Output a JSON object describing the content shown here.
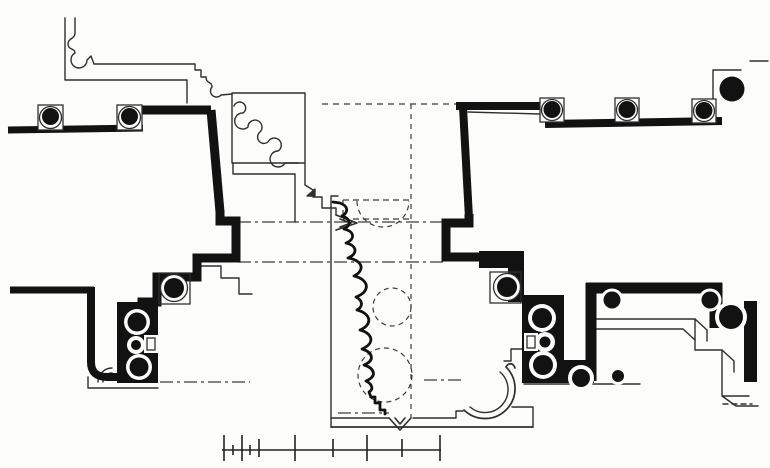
{
  "canvas": {
    "width": 770,
    "height": 468,
    "paper": "#fcfcfa",
    "ink": "#121212"
  },
  "figure": {
    "kind": "architectural-plan-drawing",
    "visible_text": ""
  },
  "drawing": {
    "layers": [
      {
        "name": "construction-lines",
        "style": {
          "stroke": "#3d3d3d",
          "width": 1.2,
          "fill": "none"
        },
        "items": [
          {
            "name": "dashed-axis-horizontal-top",
            "d": "M322,104 H456",
            "dash": "6 5"
          },
          {
            "name": "dashed-axis-vertical-center",
            "d": "M411,104 V418",
            "dash": "5 5"
          },
          {
            "name": "dashdot-line-upper",
            "d": "M238,222 H443",
            "dash": "13 4 3 4"
          },
          {
            "name": "dashdot-line-lower",
            "d": "M238,262 H443",
            "dash": "13 4 3 4"
          },
          {
            "name": "dashdot-line-left-bottom",
            "d": "M160,382 H250",
            "dash": "13 4 3 4"
          },
          {
            "name": "dashdot-line-right-bottom",
            "d": "M424,380 H464",
            "dash": "13 4 3 4"
          },
          {
            "name": "dashdot-line-niche-bottom",
            "d": "M338,413 H389",
            "dash": "13 4 3 4"
          },
          {
            "name": "dashed-pier-outline-box",
            "d": "M343,200 H411 M343,219 H411 M343,200 V219",
            "dash": "6 4"
          },
          {
            "name": "dashed-semicircle-top",
            "d": "M357,201 A26,26 0 0 0 409,201",
            "dash": "5 4"
          },
          {
            "name": "dashed-circle-middle",
            "cx": 392,
            "cy": 307,
            "r": 19,
            "dash": "5 4"
          },
          {
            "name": "dashed-circle-lower",
            "cx": 385,
            "cy": 375,
            "r": 27,
            "dash": "5 4"
          }
        ]
      },
      {
        "name": "thin-outlines",
        "style": {
          "stroke": "#2f2f2f",
          "width": 1.4,
          "fill": "none",
          "join": "round",
          "cap": "round"
        },
        "items": [
          {
            "name": "molding-inner-line",
            "d": "M65,18 V80 H187 V103"
          },
          {
            "name": "molding-outer-profile",
            "d": "M75,18 V33 C75,39 68,38 68,44 C68,50 75,48 75,53 A8,8 0 1 0 87,60 L91,56 L94,64 L195,64 V70 H201 V77 H206 C206,84 212,81 212,87 A6,6 0 1 0 221,95 L232,94"
          },
          {
            "name": "pier-panel-square",
            "d": "M232,93 H305 V163 H232 Z"
          },
          {
            "name": "pier-panel-molding-squiggle",
            "d": "M234,106 a6,6 0 1 1 9,7 a8,8 0 1 0 5,14 a7,7 0 1 1 12,5 a6,6 0 1 0 8,10 a7,7 0 1 1 10,9 a8,8 0 1 0 7,12 l13,0"
          },
          {
            "name": "project-outline-left",
            "d": "M233,163 V174 H295 V222"
          },
          {
            "name": "project-outline-right",
            "d": "M305,163 V185 L313,190 V197 H322 V208 H336 V215"
          },
          {
            "name": "arrow-point-mark",
            "d": "M336,215 L357,223 L336,230 M340,219 L351,223 L340,227",
            "width": 1.7
          },
          {
            "name": "triangle-hatch-mark",
            "d": "M307,196 L315,189 L315,196 Z",
            "fill": "#2f2f2f"
          },
          {
            "name": "central-bay-left-edge",
            "d": "M331,196 H338 M331,196 V427"
          },
          {
            "name": "step-outline-left-pier",
            "d": "M200,266 H221 V278 H239 V294 H252"
          },
          {
            "name": "bottom-band-lower",
            "d": "M331,427 H533",
            "width": 1.7
          },
          {
            "name": "bottom-band-upper",
            "d": "M331,418 H389 M413,418 H456 V411 H463"
          },
          {
            "name": "chevron-notch",
            "d": "M389,418 L400,430 L411,418 M395,418 L400,424 L405,418",
            "width": 1.6
          },
          {
            "name": "niche-arc-outer",
            "d": "M464,410 A28,28 0 0 0 506,367 C508,363 513,362 515,368",
            "width": 1.7
          },
          {
            "name": "niche-arc-inner",
            "d": "M470,407 A22,22 0 0 0 500,372"
          },
          {
            "name": "niche-link-steps",
            "d": "M525,349 H511 V361 H504"
          },
          {
            "name": "bottom-band-right",
            "d": "M512,407 H533 V427"
          },
          {
            "name": "left-pier-base-lines",
            "d": "M88,377 V388 H158"
          },
          {
            "name": "left-pier-corner-arcs",
            "d": "M98,382 A14,14 0 0 1 112,368 M103,382 A9,9 0 0 1 112,373"
          },
          {
            "name": "right-pier-base-line",
            "d": "M524,384 H640"
          },
          {
            "name": "colonnade-underline-right",
            "d": "M468,112 L540,114"
          },
          {
            "name": "corner-square-top-right",
            "d": "M713,102 V70 H741"
          },
          {
            "name": "edge-tick-top-right",
            "d": "M750,61 H768"
          },
          {
            "name": "u-wall-inner-upper",
            "d": "M593,319 H695 M593,329 H683 L695,340"
          },
          {
            "name": "axon-steps-outline",
            "d": "M695,319 V350 H722 V396 H749 M695,319 L707,330 M707,330 V341 M722,350 L734,361 M734,361 V372 M722,396 L736,406 M736,406 H758"
          },
          {
            "name": "axon-steps-dash",
            "d": "M723,404 H752",
            "dash": "5 4"
          }
        ]
      },
      {
        "name": "thick-walls",
        "style": {
          "stroke": "#121212",
          "width": 8,
          "fill": "none",
          "cap": "butt",
          "join": "miter"
        },
        "items": [
          {
            "name": "wall-top-left-low",
            "d": "M8,130 L143,128",
            "width": 7
          },
          {
            "name": "wall-top-left-riser",
            "d": "M139,128 V110",
            "width": 7
          },
          {
            "name": "wall-top-left-high",
            "d": "M137,110 H211",
            "width": 9
          },
          {
            "name": "wall-left-diagonal",
            "d": "M211,110 L220,212",
            "width": 9
          },
          {
            "name": "wall-left-steps",
            "d": "M220,210 L220,221 H236 V258 H197 V277 H157 V302 H142 V307",
            "width": 9
          },
          {
            "name": "wall-top-right-upper",
            "d": "M456,106 H546",
            "width": 8
          },
          {
            "name": "wall-right-diagonal",
            "d": "M463,107 L469,218",
            "width": 8
          },
          {
            "name": "wall-right-steps",
            "d": "M469,214 V223 H446 V257 H492",
            "width": 9
          },
          {
            "name": "wall-top-right-lower",
            "d": "M545,124 L722,121",
            "width": 8
          },
          {
            "name": "wall-bottom-left",
            "d": "M10,290 H94",
            "width": 7
          },
          {
            "name": "wall-bottom-left-leg",
            "d": "M91,287 V362 Q91,377 107,377 L119,377",
            "width": 8
          },
          {
            "name": "u-wall-top",
            "d": "M586,288 H722",
            "width": 11
          },
          {
            "name": "u-wall-left-leg",
            "d": "M591,283 V381",
            "width": 11
          },
          {
            "name": "u-wall-right-leg",
            "d": "M716,283 V328",
            "width": 13
          }
        ]
      },
      {
        "name": "black-masses",
        "style": {
          "stroke": "none",
          "fill": "#121212"
        },
        "items": [
          {
            "name": "left-pier-slab",
            "x": 117,
            "y": 302,
            "w": 41,
            "h": 81
          },
          {
            "name": "right-pier-bar",
            "x": 479,
            "y": 251,
            "w": 45,
            "h": 17
          },
          {
            "name": "right-pier-vert",
            "x": 508,
            "y": 262,
            "w": 16,
            "h": 40
          },
          {
            "name": "right-pier-slab",
            "x": 522,
            "y": 295,
            "w": 42,
            "h": 88
          },
          {
            "name": "right-pier-foot",
            "x": 560,
            "y": 360,
            "w": 34,
            "h": 23
          },
          {
            "name": "right-edge-bar",
            "x": 744,
            "y": 301,
            "w": 13,
            "h": 81
          }
        ]
      },
      {
        "name": "engaged-ring-columns",
        "style": {
          "stroke": "#2f2f2f",
          "width": 1.3,
          "fill": "none"
        },
        "items": [
          {
            "name": "left-pier-capital-square",
            "x": 159,
            "y": 273,
            "w": 31,
            "h": 31
          },
          {
            "name": "right-pier-capital-square",
            "x": 490,
            "y": 272,
            "w": 31,
            "h": 31
          },
          {
            "name": "ring-col-A-white",
            "cx": 174,
            "cy": 288,
            "r": 13.5,
            "fill": "#fcfcfa"
          },
          {
            "name": "ring-col-A-core",
            "cx": 174,
            "cy": 288,
            "r": 10,
            "fill": "#121212",
            "stroke": "none"
          },
          {
            "name": "ring-col-B-white",
            "cx": 137,
            "cy": 322,
            "r": 13,
            "fill": "#fcfcfa",
            "stroke": "none"
          },
          {
            "name": "ring-col-B-core",
            "cx": 137,
            "cy": 322,
            "r": 9.5,
            "fill": "#121212",
            "stroke": "none"
          },
          {
            "name": "ring-col-C-white",
            "cx": 136,
            "cy": 345,
            "r": 9,
            "fill": "#fcfcfa",
            "stroke": "none"
          },
          {
            "name": "ring-col-C-core",
            "cx": 136,
            "cy": 345,
            "r": 5,
            "fill": "#121212",
            "stroke": "none"
          },
          {
            "name": "ring-col-D-white",
            "cx": 139,
            "cy": 367,
            "r": 13,
            "fill": "#fcfcfa",
            "stroke": "none"
          },
          {
            "name": "ring-col-D-core",
            "cx": 139,
            "cy": 367,
            "r": 9.5,
            "fill": "#121212",
            "stroke": "none"
          },
          {
            "name": "ring-col-F-white",
            "cx": 507,
            "cy": 287,
            "r": 13.5,
            "fill": "#fcfcfa"
          },
          {
            "name": "ring-col-F-core",
            "cx": 507,
            "cy": 287,
            "r": 10,
            "fill": "#121212",
            "stroke": "none"
          },
          {
            "name": "ring-col-G-white",
            "cx": 542,
            "cy": 318,
            "r": 14,
            "fill": "#fcfcfa",
            "stroke": "none"
          },
          {
            "name": "ring-col-G-core",
            "cx": 542,
            "cy": 318,
            "r": 10,
            "fill": "#121212",
            "stroke": "none"
          },
          {
            "name": "ring-col-H-white",
            "cx": 545,
            "cy": 342,
            "r": 10,
            "fill": "#fcfcfa",
            "stroke": "none"
          },
          {
            "name": "ring-col-H-core",
            "cx": 545,
            "cy": 342,
            "r": 5.5,
            "fill": "#121212",
            "stroke": "none"
          },
          {
            "name": "ring-col-I-white",
            "cx": 543,
            "cy": 365,
            "r": 14,
            "fill": "#fcfcfa",
            "stroke": "none"
          },
          {
            "name": "ring-col-I-core",
            "cx": 543,
            "cy": 365,
            "r": 10,
            "fill": "#121212",
            "stroke": "none"
          },
          {
            "name": "ring-col-J-white",
            "cx": 581,
            "cy": 378,
            "r": 13,
            "fill": "#fcfcfa",
            "stroke": "none"
          },
          {
            "name": "ring-col-J-core",
            "cx": 581,
            "cy": 378,
            "r": 9,
            "fill": "#121212",
            "stroke": "none"
          },
          {
            "name": "ring-col-L-white",
            "cx": 612,
            "cy": 300,
            "r": 11.5,
            "fill": "#fcfcfa",
            "stroke": "none"
          },
          {
            "name": "ring-col-L-core",
            "cx": 612,
            "cy": 300,
            "r": 8.5,
            "fill": "#121212",
            "stroke": "none"
          },
          {
            "name": "ring-col-M-white",
            "cx": 710,
            "cy": 300,
            "r": 11.5,
            "fill": "#fcfcfa",
            "stroke": "none"
          },
          {
            "name": "ring-col-M-core",
            "cx": 710,
            "cy": 300,
            "r": 8.5,
            "fill": "#121212",
            "stroke": "none"
          },
          {
            "name": "ring-col-K-white",
            "cx": 731,
            "cy": 317,
            "r": 16,
            "fill": "#fcfcfa",
            "stroke": "none"
          },
          {
            "name": "ring-col-K-core",
            "cx": 731,
            "cy": 317,
            "r": 12,
            "fill": "#121212",
            "stroke": "none"
          },
          {
            "name": "ring-col-leg-foot-white",
            "cx": 618,
            "cy": 376,
            "r": 9,
            "fill": "#fcfcfa",
            "stroke": "none"
          },
          {
            "name": "ring-col-leg-foot-core",
            "cx": 618,
            "cy": 376,
            "r": 6,
            "fill": "#121212",
            "stroke": "none"
          },
          {
            "name": "left-pier-notch-white",
            "x": 144,
            "y": 335,
            "w": 14,
            "h": 18,
            "fill": "#fcfcfa",
            "stroke": "none"
          },
          {
            "name": "left-pier-notch-outline",
            "x": 147,
            "y": 338,
            "w": 8,
            "h": 12
          },
          {
            "name": "right-pier-notch-white",
            "x": 524,
            "y": 333,
            "w": 14,
            "h": 18,
            "fill": "#fcfcfa",
            "stroke": "none"
          },
          {
            "name": "right-pier-notch-outline",
            "x": 527,
            "y": 336,
            "w": 8,
            "h": 12
          }
        ]
      },
      {
        "name": "plinth-columns",
        "style": {
          "stroke": "#2f2f2f",
          "width": 1.3,
          "fill": "none"
        },
        "items": [
          {
            "name": "plinth-left-1-square",
            "x": 38,
            "y": 105,
            "w": 25,
            "h": 25,
            "fill": "#fcfcfa"
          },
          {
            "name": "plinth-left-1-ring",
            "cx": 50.5,
            "cy": 117.5,
            "r": 11
          },
          {
            "name": "plinth-left-1-core",
            "cx": 50.5,
            "cy": 116.5,
            "r": 8.5,
            "fill": "#121212",
            "stroke": "none"
          },
          {
            "name": "plinth-left-2-square",
            "x": 117,
            "y": 105,
            "w": 25,
            "h": 25,
            "fill": "#fcfcfa"
          },
          {
            "name": "plinth-left-2-ring",
            "cx": 129.5,
            "cy": 117.5,
            "r": 11
          },
          {
            "name": "plinth-left-2-core",
            "cx": 129.5,
            "cy": 116.5,
            "r": 8.5,
            "fill": "#121212",
            "stroke": "none"
          },
          {
            "name": "plinth-right-1-square",
            "x": 540,
            "y": 98,
            "w": 24,
            "h": 24,
            "fill": "#fcfcfa"
          },
          {
            "name": "plinth-right-1-ring",
            "cx": 552,
            "cy": 110,
            "r": 10.5
          },
          {
            "name": "plinth-right-1-core",
            "cx": 552,
            "cy": 109.5,
            "r": 8.5,
            "fill": "#121212",
            "stroke": "none"
          },
          {
            "name": "plinth-right-2-square",
            "x": 615,
            "y": 98,
            "w": 24,
            "h": 24,
            "fill": "#fcfcfa"
          },
          {
            "name": "plinth-right-2-ring",
            "cx": 627,
            "cy": 110,
            "r": 10.5
          },
          {
            "name": "plinth-right-2-core",
            "cx": 627,
            "cy": 109.5,
            "r": 8.5,
            "fill": "#121212",
            "stroke": "none"
          },
          {
            "name": "plinth-right-3-square",
            "x": 692,
            "y": 99,
            "w": 24,
            "h": 24,
            "fill": "#fcfcfa"
          },
          {
            "name": "plinth-right-3-ring",
            "cx": 704,
            "cy": 111,
            "r": 10.5
          },
          {
            "name": "plinth-right-3-core",
            "cx": 704,
            "cy": 110.5,
            "r": 8.5,
            "fill": "#121212",
            "stroke": "none"
          },
          {
            "name": "corner-column-big-core",
            "cx": 732,
            "cy": 89,
            "r": 12.5,
            "fill": "#121212",
            "stroke": "none"
          }
        ]
      },
      {
        "name": "section-profile",
        "style": {
          "stroke": "#121212",
          "width": 2.8,
          "fill": "none",
          "join": "round",
          "cap": "round"
        },
        "items": [
          {
            "name": "wavy-molding-profile",
            "d": "M333,202 L340,203 C348,206 349,212 342,216 C350,218 352,225 344,229 C354,231 356,239 346,243 C356,245 359,253 348,258 C362,260 366,270 354,276 C368,279 372,291 356,297 C362,300 364,306 357,310 C370,313 374,324 360,330 C372,333 376,343 362,349 C372,352 376,360 364,365 C374,368 378,376 366,381 C372,384 374,389 369,392 L371,397 L375,397 L375,403 L380,403 L380,410 L385,410 L385,414"
          }
        ]
      }
    ],
    "scale_bar": {
      "name": "scale-bar",
      "y": 450,
      "x1": 222,
      "x2": 441,
      "stroke": "#222222",
      "width": 1.6,
      "tick_heights": {
        "tall": [
          435,
          461
        ],
        "med": [
          439,
          457
        ],
        "small": [
          445,
          455
        ]
      },
      "ticks": [
        {
          "x": 224,
          "size": "tall"
        },
        {
          "x": 233,
          "size": "small"
        },
        {
          "x": 242,
          "size": "tall"
        },
        {
          "x": 250,
          "size": "small"
        },
        {
          "x": 259,
          "size": "med"
        },
        {
          "x": 295,
          "size": "tall"
        },
        {
          "x": 333,
          "size": "med"
        },
        {
          "x": 367,
          "size": "tall"
        },
        {
          "x": 402,
          "size": "med"
        },
        {
          "x": 440,
          "size": "tall"
        }
      ]
    }
  }
}
